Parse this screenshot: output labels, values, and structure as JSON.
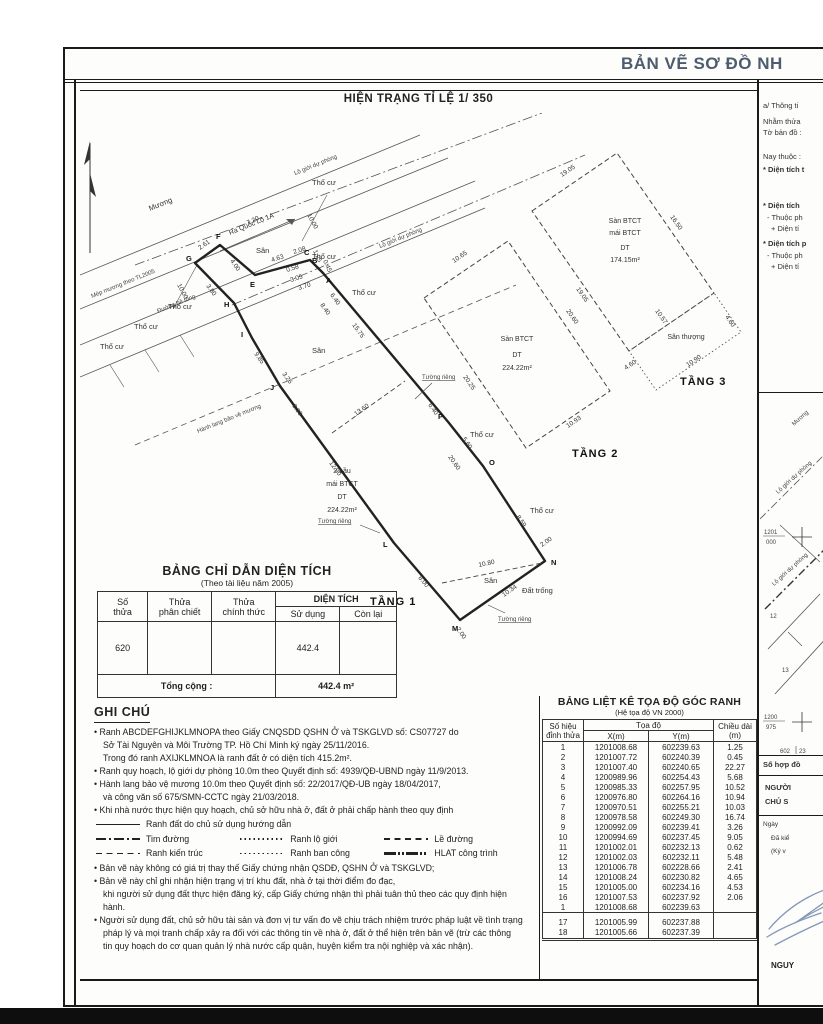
{
  "page": {
    "title": "BẢN VẼ SƠ ĐỒ NH"
  },
  "plan": {
    "subtitle": "HIỆN TRẠNG TỈ LỆ 1/ 350",
    "labels": {
      "muong": "Mương",
      "ra_ql": "Ra Quốc Lộ 1A",
      "lo_gioi": "Lộ giới dự phòng",
      "mep": "Mép mương theo TL2005",
      "duong_bt": "Đường bê tông",
      "hanh_lang": "Hành lang bảo vệ mương",
      "tho_cu": "Thổ cư",
      "san": "Sân",
      "dat_trong": "Đất trống",
      "tuong_rieng": "Tường riêng",
      "tang1": "TẦNG 1",
      "tang2": "TẦNG 2",
      "tang3": "TẦNG 3",
      "san_thuong": "Sân thượng",
      "h1a": "2 Lầu",
      "h1b": "mái BTCT",
      "h1c": "DT",
      "h1d": "224.22m²",
      "t2a": "Sàn BTCT",
      "t2b": "DT",
      "t2c": "224.22m²",
      "t3a": "Sàn BTCT",
      "t3b": "mái BTCT",
      "t3c": "DT",
      "t3d": "174.15m²"
    },
    "points": {
      "a": "A",
      "b": "B",
      "c": "C",
      "e": "E",
      "f": "F",
      "g": "G",
      "h": "H",
      "i": "I",
      "j": "J",
      "l": "L",
      "m": "M",
      "n": "N",
      "o": "O",
      "p": "P"
    },
    "dims": {
      "d720": "7.20",
      "d261": "2.61",
      "d400": "4.00",
      "d463": "4.63",
      "d058": "0.58",
      "d208": "2.08",
      "d125": "1.25",
      "d045": "0.45",
      "d305": "3.05",
      "d370": "3.70",
      "d640": "6.40",
      "d840": "8.40",
      "d1575": "15.75",
      "d560": "5.60",
      "d2060": "20.60",
      "d859": "8.59",
      "d200": "2.00",
      "d1034": "10.34",
      "d800": "8.00",
      "d1290": "12.90",
      "d390": "3.90",
      "d326": "3.26",
      "d985": "9.85",
      "d380": "3.80",
      "d1000": "10.00",
      "d1360": "13.60",
      "d1080": "10.80",
      "d1065": "10.65",
      "d2025": "20.25",
      "d1093": "10.93",
      "d1905": "19.05",
      "d1650": "16.50",
      "d1057": "10.57",
      "d460": "4.60",
      "d1090": "10.90"
    }
  },
  "area_table": {
    "title": "BẢNG CHỈ DẪN DIỆN TÍCH",
    "subtitle": "(Theo tài liệu năm 2005)",
    "h_so1": "Số",
    "h_so2": "thửa",
    "h_ph1": "Thửa",
    "h_ph2": "phân chiết",
    "h_ch1": "Thửa",
    "h_ch2": "chính thức",
    "h_dt": "DIỆN TÍCH",
    "h_sd": "Sử dụng",
    "h_cl": "Còn lại",
    "row": {
      "so": "620",
      "sd": "442.4"
    },
    "total_label": "Tổng cộng :",
    "total_value": "442.4 m²"
  },
  "notes": {
    "heading": "GHI CHÚ",
    "b1a": "• Ranh ABCDEFGHIJKLMNOPA theo Giấy CNQSDD QSHN Ở và TSKGLVD số: CS07727 do",
    "b1b": "Sở Tài Nguyên và Môi Trường TP. Hồ Chí Minh ký ngày 25/11/2016.",
    "b1c": "Trong đó ranh AXIJKLMNOA là ranh đất ở có diện tích 415.2m².",
    "b2": "• Ranh quy hoạch, lộ giới dự phòng 10.0m theo Quyết định số: 4939/QĐ-UBND ngày 11/9/2013.",
    "b3a": "• Hành lang bảo vệ mương 10.0m theo Quyết định số: 22/2017/QĐ-UB ngày 18/04/2017,",
    "b3b": "và công văn số 675/SMN-CCTC ngày 21/03/2018.",
    "b4": "• Khi nhà nước thực hiện quy hoạch, chủ sở hữu nhà ở, đất ở phải chấp hành theo quy định",
    "legend": {
      "l0": "Ranh đất do chủ sử dụng hướng dẫn",
      "l1": "Tim đường",
      "l2": "Ranh lộ giới",
      "l3": "Lề đường",
      "l4": "Ranh kiến trúc",
      "l5": "Ranh ban công",
      "l6": "HLAT công trình"
    },
    "b5": "• Bản vẽ này không có giá trị thay thế Giấy chứng nhận QSDĐ, QSHN Ở và TSKGLVD;",
    "b6a": "• Bản vẽ này chỉ ghi nhận hiện trạng vị trí khu đất, nhà ở tại thời điểm đo đạc,",
    "b6b": "khi người sử dụng đất thực hiện đăng ký, cấp Giấy chứng nhận thì phải tuân thủ theo các quy định hiện hành.",
    "b7a": "• Người sử dụng đất, chủ sở hữu tài sản và đơn vị tư vấn đo vẽ chịu trách nhiệm trước pháp luật về tình trạng",
    "b7b": "pháp lý và mọi tranh chấp xảy ra đối với các thông tin về nhà ở, đất ở thể hiện trên bản vẽ (trừ các thông",
    "b7c": "tin quy hoạch do cơ quan quản lý nhà nước cấp quận, huyện kiểm tra nội nghiệp và xác nhận)."
  },
  "coord_table": {
    "title": "BẢNG LIỆT KÊ TỌA ĐỘ GÓC RANH",
    "subtitle": "(Hệ tọa độ VN 2000)",
    "h_id1": "Số hiệu",
    "h_id2": "đỉnh thửa",
    "h_toado": "Tọa độ",
    "h_x": "X(m)",
    "h_y": "Y(m)",
    "h_d1": "Chiều dài",
    "h_d2": "(m)",
    "rows": [
      {
        "n": "1",
        "x": "1201008.68",
        "y": "602239.63",
        "d": "1.25"
      },
      {
        "n": "2",
        "x": "1201007.72",
        "y": "602240.39",
        "d": "0.45"
      },
      {
        "n": "3",
        "x": "1201007.40",
        "y": "602240.65",
        "d": "22.27"
      },
      {
        "n": "4",
        "x": "1200989.96",
        "y": "602254.43",
        "d": "5.68"
      },
      {
        "n": "5",
        "x": "1200985.33",
        "y": "602257.95",
        "d": "10.52"
      },
      {
        "n": "6",
        "x": "1200976.80",
        "y": "602264.16",
        "d": "10.94"
      },
      {
        "n": "7",
        "x": "1200970.51",
        "y": "602255.21",
        "d": "10.03"
      },
      {
        "n": "8",
        "x": "1200978.58",
        "y": "602249.30",
        "d": "16.74"
      },
      {
        "n": "9",
        "x": "1200992.09",
        "y": "602239.41",
        "d": "3.26"
      },
      {
        "n": "10",
        "x": "1200994.69",
        "y": "602237.45",
        "d": "9.05"
      },
      {
        "n": "11",
        "x": "1201002.01",
        "y": "602232.13",
        "d": "0.62"
      },
      {
        "n": "12",
        "x": "1201002.03",
        "y": "602232.11",
        "d": "5.48"
      },
      {
        "n": "13",
        "x": "1201006.78",
        "y": "602228.66",
        "d": "2.41"
      },
      {
        "n": "14",
        "x": "1201008.24",
        "y": "602230.82",
        "d": "4.65"
      },
      {
        "n": "15",
        "x": "1201005.00",
        "y": "602234.16",
        "d": "4.53"
      },
      {
        "n": "16",
        "x": "1201007.53",
        "y": "602237.92",
        "d": "2.06"
      },
      {
        "n": "1",
        "x": "1201008.68",
        "y": "602239.63",
        "d": ""
      },
      {
        "n": "17",
        "x": "1201005.99",
        "y": "602237.88",
        "d": ""
      },
      {
        "n": "18",
        "x": "1201005.66",
        "y": "602237.39",
        "d": ""
      }
    ]
  },
  "side": {
    "a_head": "a/ Thông ti",
    "lines": [
      "Nhằm thửa",
      "Tờ bản đồ :",
      "Nay thuộc :",
      "* Diện tích t",
      "* Diện tích",
      "- Thuộc ph",
      "+ Diện tí",
      "* Diện tích p",
      "- Thuộc ph",
      "+ Diện tí"
    ],
    "map": {
      "muong": "Mương",
      "lo_gioi": "Lộ giới dự phòng",
      "g1n": "1201",
      "g1d": "000",
      "g2n": "1200",
      "g2d": "975",
      "gx": "602",
      "gx2": "23",
      "n12": "12",
      "n13": "13"
    },
    "contract": "Số hợp đồ",
    "nguoi": "NGƯỜI",
    "chu": "CHỦ S",
    "ngay": "Ngày",
    "dakiem": "Đã kiể",
    "kyva": "(Ký v",
    "sig_name": "NGUY"
  }
}
